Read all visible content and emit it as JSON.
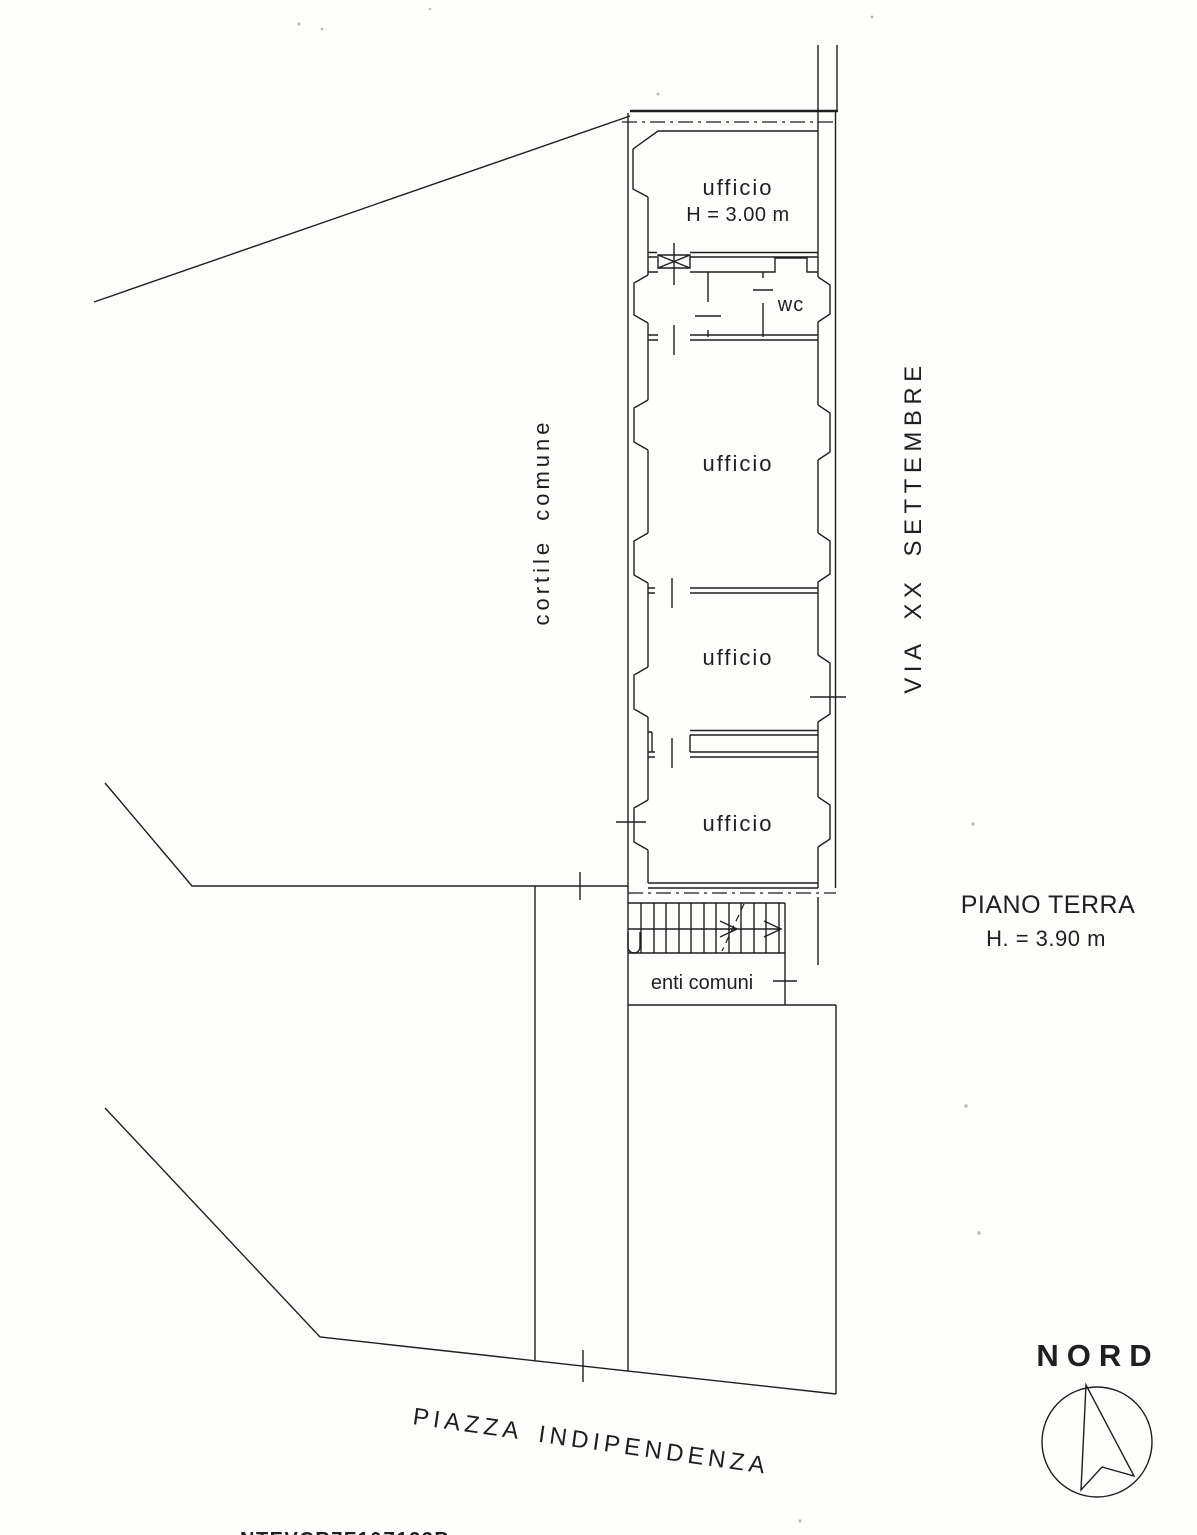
{
  "page": {
    "background": "#fdfdfc",
    "ink": "#1f1f1f"
  },
  "plan": {
    "rooms": [
      {
        "id": "room-1",
        "label": "ufficio",
        "sublabel": "H = 3.00 m"
      },
      {
        "id": "wc",
        "label": "wc"
      },
      {
        "id": "room-2",
        "label": "ufficio"
      },
      {
        "id": "room-3",
        "label": "ufficio"
      },
      {
        "id": "room-4",
        "label": "ufficio"
      }
    ],
    "common_area_label": "enti comuni",
    "courtyard_label": "cortile comune",
    "street_label": "VIA XX SETTEMBRE",
    "square_label": "PIAZZA INDIPENDENZA",
    "floor_title": "PIANO TERRA",
    "floor_height": "H. = 3.90 m",
    "compass_label": "NORD",
    "bottom_cutoff_text": "NTEVCR7F10Z122B"
  }
}
